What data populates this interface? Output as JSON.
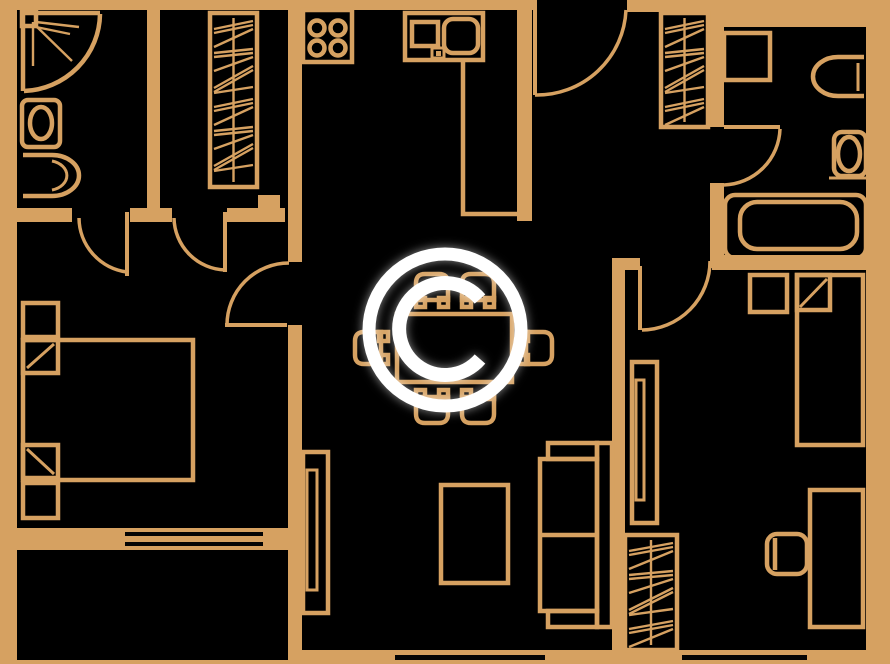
{
  "watermark": {
    "glyph": "C"
  },
  "colors": {
    "background": "#000000",
    "line": "#D6A161",
    "watermark": "#FFFFFF",
    "window": "#050505"
  },
  "plan": {
    "type": "apartment-floor-plan",
    "rooms": [
      {
        "name": "bathroom",
        "fixtures": [
          "corner-shower",
          "toilet",
          "wash-basin"
        ]
      },
      {
        "name": "entry-hall",
        "fixtures": [
          "wardrobe",
          "entrance-door"
        ]
      },
      {
        "name": "kitchen",
        "fixtures": [
          "stove-4-burners",
          "counter-with-sink",
          "worktop"
        ]
      },
      {
        "name": "second-bathroom",
        "fixtures": [
          "washing-machine",
          "wash-basin",
          "toilet",
          "bathtub"
        ]
      },
      {
        "name": "bedroom",
        "fixtures": [
          "double-bed",
          "nightstand",
          "nightstand",
          "pillows"
        ]
      },
      {
        "name": "living-dining-room",
        "fixtures": [
          "dining-table",
          "six-chairs",
          "sofa",
          "coffee-table",
          "tv-unit"
        ]
      },
      {
        "name": "second-bedroom",
        "fixtures": [
          "single-bed",
          "nightstand",
          "desk",
          "desk-chair",
          "wardrobe",
          "tv-unit"
        ]
      },
      {
        "name": "balcony",
        "fixtures": [
          "window-wall"
        ]
      }
    ]
  }
}
